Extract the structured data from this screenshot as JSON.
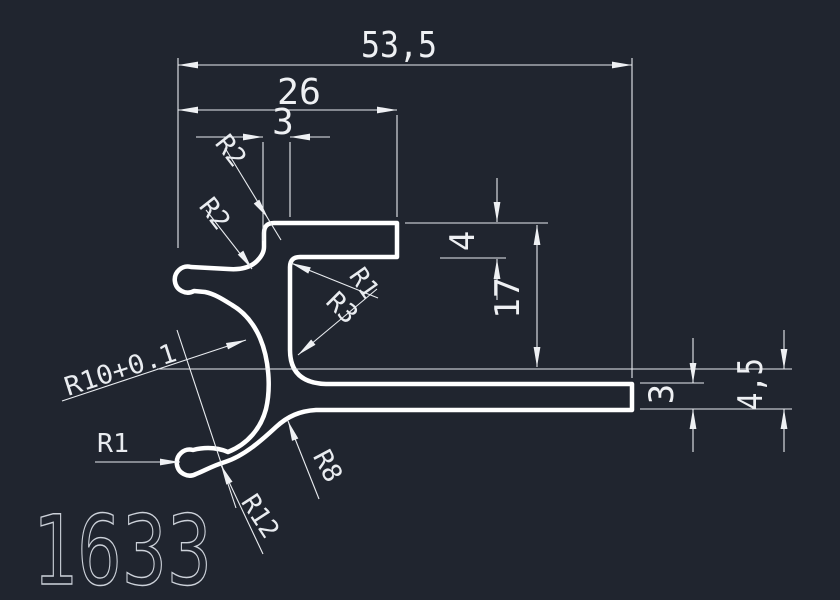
{
  "drawing": {
    "part_number": "1633",
    "linear_dimensions": {
      "total_width": "53,5",
      "top_flange_width": "26",
      "wall_thickness": "3",
      "flange_thickness": "4",
      "channel_height": "17",
      "leg_thickness": "3",
      "leg_end_height": "4,5"
    },
    "radius_labels": {
      "r2_outer_corner": "R2",
      "r2_arm_fillet": "R2",
      "r1_inner_corner": "R1",
      "r3_inner_fillet": "R3",
      "r10_bore": "R10+0.1",
      "r1_hook_tip": "R1",
      "r12_outer_sweep": "R12",
      "r8_outer_fillet": "R8"
    },
    "colors": {
      "background": "#20252f",
      "profile_line": "#ffffff",
      "dimension_line": "#edeff2",
      "part_number_text": "#ccd1d9"
    }
  }
}
